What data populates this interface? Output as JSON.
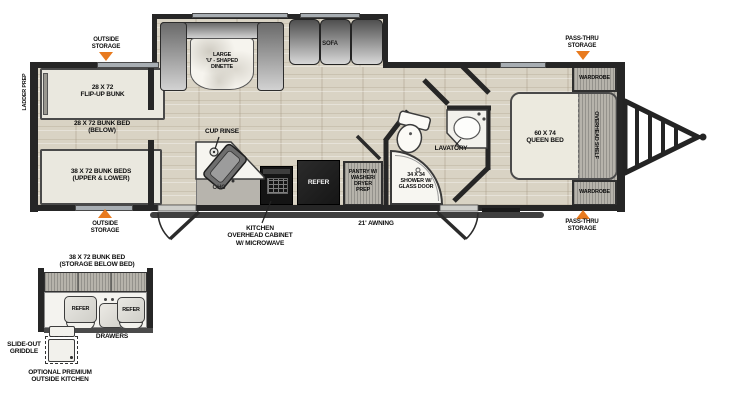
{
  "colors": {
    "accent_orange": "#e87a1e",
    "wall_dark": "#262626",
    "floor_wood": "#d9d3c4",
    "refer_black": "#1f1f1f"
  },
  "plan": {
    "ladder_prep": "LADDER PREP",
    "outside_storage_top": "OUTSIDE\nSTORAGE",
    "outside_storage_bottom": "OUTSIDE\nSTORAGE",
    "pass_thru_top": "PASS-THRU\nSTORAGE",
    "pass_thru_bottom": "PASS-THRU\nSTORAGE",
    "flip_up_bunk": "28 X 72\nFLIP-UP BUNK",
    "bunk_below": "28 X 72 BUNK BED\n(BELOW)",
    "bunk_upper_lower": "38 X 72 BUNK BEDS\n(UPPER & LOWER)",
    "dinette": "LARGE\n'U' - SHAPED\nDINETTE",
    "sofa": "SOFA",
    "cup_rinse": "CUP RINSE",
    "ohc": "OHC",
    "kitchen_cabinet": "KITCHEN\nOVERHEAD CABINET\nW/ MICROWAVE",
    "refer": "REFER",
    "pantry": "PANTRY W/\nWASHER/\nDRYER\nPREP",
    "awning": "21' AWNING",
    "lavatory": "LAVATORY",
    "shower": "34 X 34\nSHOWER W/\nGLASS DOOR",
    "queen_bed": "60 X 74\nQUEEN BED",
    "wardrobe_top": "WARDROBE",
    "wardrobe_bottom": "WARDROBE",
    "overhead_shelf": "OVERHEAD SHELF"
  },
  "outside_kitchen": {
    "bunk": "38 X 72 BUNK BED\n(STORAGE BELOW BED)",
    "refer_left": "REFER",
    "refer_right": "REFER",
    "drawers": "DRAWERS",
    "griddle": "SLIDE-OUT\nGRIDDLE",
    "caption": "OPTIONAL PREMIUM\nOUTSIDE KITCHEN"
  }
}
